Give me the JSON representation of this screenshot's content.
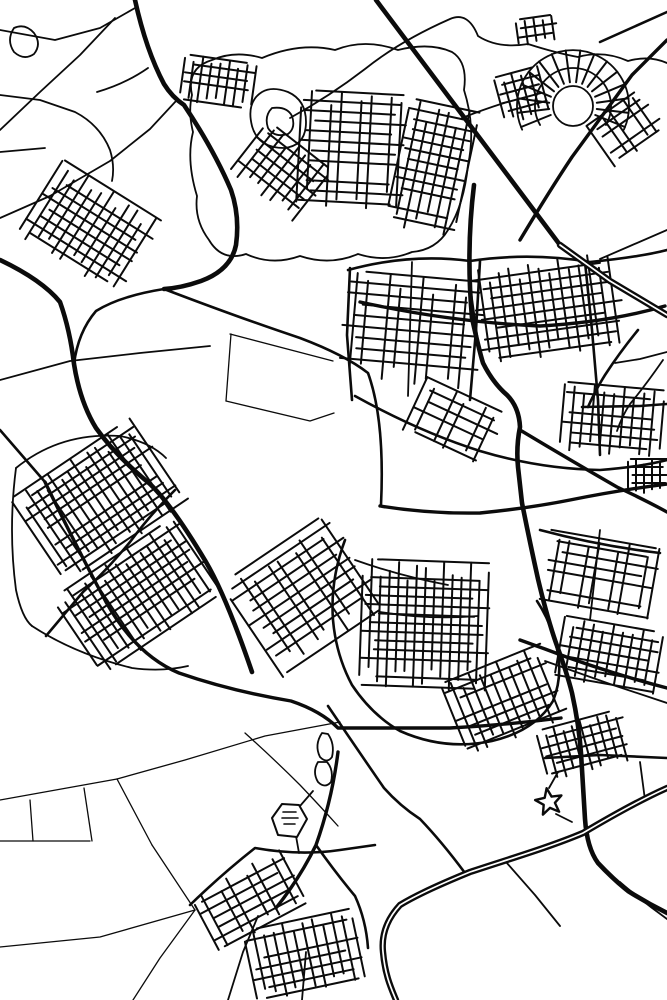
{
  "map": {
    "background": "#ffffff",
    "ink": "#0b0b0b",
    "landmark_fill": "#ffffff",
    "widths": {
      "xs": 1.3,
      "s": 1.8,
      "m": 2.6,
      "l": 3.4,
      "xl": 4.6,
      "grid": 2.0,
      "mw_outer": 6.4,
      "mw_inner": 1.7
    },
    "motorways": [
      "M667,788 C640,800 610,817 583,833 C550,847 506,860 470,872 C443,883 418,894 400,905 C388,918 381,933 383,952 C385,975 391,988 396,1000",
      "M560,245 L610,281 L667,315"
    ],
    "roads": [
      {
        "c": "xl",
        "d": "M376,0 L560,245"
      },
      {
        "c": "xl",
        "d": "M474,185 Q466,250 472,318 Q479,350 483,363 Q493,383 507,395 Q519,407 520,427 Q516,447 518,467 Q520,485 522,503 Q530,543 538,579 Q547,617 556,643 Q567,673 572,693 Q579,725 581,753 Q583,787 585,819 Q587,848 598,863 Q613,879 628,891 Q647,903 667,913"
      },
      {
        "c": "xl",
        "d": "M135,0 Q146,50 164,84 Q172,97 184,105 Q214,150 231,190 Q240,216 236,245 Q231,270 201,281 Q181,288 164,289"
      },
      {
        "c": "xl",
        "d": "M0,260 Q42,280 60,302 Q70,330 74,364 Q80,402 96,428 Q116,456 150,484 Q172,505 206,562 Q226,596 252,672"
      },
      {
        "c": "l",
        "d": "M45,482 Q76,546 106,602 Q136,655 179,673 Q231,691 291,701 Q321,711 338,728 L450,728 Q506,725 561,718"
      },
      {
        "c": "l",
        "d": "M380,506 Q430,514 480,513 Q530,508 570,500 Q620,490 667,484"
      },
      {
        "c": "l",
        "d": "M520,430 Q570,460 617,487 Q645,500 667,512"
      },
      {
        "c": "l",
        "d": "M520,640 L545,649 Q602,671 667,688"
      },
      {
        "c": "l",
        "d": "M667,40 L632,75 L572,157 Q550,190 520,240"
      },
      {
        "c": "l",
        "d": "M338,752 Q332,800 316,845 Q300,878 276,908"
      },
      {
        "c": "l",
        "d": "M360,302 Q450,322 540,326 Q610,322 665,306"
      },
      {
        "c": "m",
        "d": "M164,289 Q240,318 300,338 Q345,355 368,373 Q385,420 381,505"
      },
      {
        "c": "m",
        "d": "M164,289 Q120,296 96,311 Q78,332 74,364"
      },
      {
        "c": "m",
        "d": "M345,540 Q330,580 333,620 Q336,655 352,685 Q372,715 400,731 Q445,751 492,741 Q535,731 553,701 Q563,676 557,649 Q551,622 537,601"
      },
      {
        "c": "m",
        "d": "M348,270 Q410,253 470,261 Q530,252 590,262 Q640,257 667,250"
      },
      {
        "c": "m",
        "d": "M585,262 L592,330 L598,400 L600,455"
      },
      {
        "c": "m",
        "d": "M480,261 L476,330 L470,400"
      },
      {
        "c": "m",
        "d": "M355,396 Q420,432 480,451 Q540,469 600,470 Q640,467 667,460"
      },
      {
        "c": "m",
        "d": "M0,430 L45,482"
      },
      {
        "c": "m",
        "d": "M175,490 Q150,515 130,542 Q105,572 83,592 L46,636"
      },
      {
        "c": "m",
        "d": "M316,845 Q335,872 355,896 Q366,920 368,948"
      },
      {
        "c": "m",
        "d": "M190,905 Q222,874 255,848 Q300,856 340,850 L375,845"
      },
      {
        "c": "m",
        "d": "M328,706 Q355,746 384,788 Q400,806 420,819 Q442,842 465,873"
      },
      {
        "c": "m",
        "d": "M545,758 L600,755 L667,758"
      },
      {
        "c": "m",
        "d": "M600,42 L667,12"
      },
      {
        "c": "m",
        "d": "M582,407 L640,406 L667,404"
      },
      {
        "c": "m",
        "d": "M638,330 Q620,352 605,375 Q595,391 588,407"
      },
      {
        "c": "m",
        "d": "M540,530 Q600,546 660,553"
      },
      {
        "c": "m",
        "d": "M350,268 L347,335 L352,400"
      },
      {
        "c": "s",
        "d": "M0,30 L55,40 L100,28 L135,8"
      },
      {
        "c": "s",
        "d": "M0,95 L40,100 L75,112 Q100,125 110,150 Q115,166 112,181"
      },
      {
        "c": "s",
        "d": "M0,152 L45,148"
      },
      {
        "c": "s",
        "d": "M0,218 L50,196 L110,161 L150,129 L176,101"
      },
      {
        "c": "s",
        "d": "M0,130 L40,92 L80,55 L115,18"
      },
      {
        "c": "s",
        "d": "M148,68 Q125,84 97,92"
      },
      {
        "c": "s",
        "d": "M0,380 L70,361 L140,353 L210,346"
      },
      {
        "c": "s",
        "d": "M290,118 Q330,96 365,69 Q400,41 450,19 Q468,11 478,36 Q498,49 528,44 Q556,53 578,57 Q603,50 628,61 Q649,55 667,63"
      },
      {
        "c": "s",
        "d": "M462,118 Q482,110 504,103"
      },
      {
        "c": "s",
        "d": "M667,230 L630,246 L600,259"
      },
      {
        "c": "s",
        "d": "M667,352 L640,359 L615,363"
      },
      {
        "c": "s",
        "d": "M663,360 Q645,386 630,404 Q622,416 617,431"
      },
      {
        "c": "s",
        "d": "M545,661 L610,684 L667,703"
      },
      {
        "c": "s",
        "d": "M506,862 L535,895 L560,926"
      },
      {
        "c": "s",
        "d": "M556,814 L572,822"
      },
      {
        "c": "s",
        "d": "M549,788 L558,772"
      },
      {
        "c": "s",
        "d": "M300,806 L313,791"
      },
      {
        "c": "s",
        "d": "M296,836 L299,853"
      },
      {
        "c": "s",
        "d": "M620,882 Q642,901 667,919"
      },
      {
        "c": "s",
        "d": "M600,530 L595,575 L590,620"
      },
      {
        "c": "s",
        "d": "M355,560 Q400,576 448,585"
      },
      {
        "c": "s",
        "d": "M380,612 Q430,620 478,616"
      },
      {
        "c": "s",
        "d": "M412,262 L408,396"
      },
      {
        "c": "s",
        "d": "M640,762 L645,800"
      },
      {
        "c": "s",
        "d": "M228,1000 L243,952 L258,916"
      },
      {
        "c": "s",
        "d": "M302,1000 L306,952"
      },
      {
        "c": "s",
        "d": "M192,95 Q186,68 212,60 Q235,50 262,58 Q300,42 335,50 Q365,38 398,50 Q430,42 452,52 Q468,62 464,90 Q476,128 468,165 Q464,205 448,230 Q436,250 412,252 Q386,263 358,254 Q330,266 300,256 Q272,266 246,254 Q222,262 209,240 Q194,220 197,196 Q186,160 193,132 Q188,112 192,95 Z"
      },
      {
        "c": "s",
        "d": "M16,468 Q60,432 120,436 Q150,442 166,458"
      },
      {
        "c": "s",
        "d": "M16,468 Q8,530 16,590 Q22,618 32,626"
      },
      {
        "c": "s",
        "d": "M32,626 Q75,654 132,668 Q162,672 188,666"
      },
      {
        "c": "s",
        "d": "M14,28 Q6,40 14,52 Q24,61 34,54 Q42,44 34,33 Q25,23 14,28 Z"
      },
      {
        "c": "s",
        "d": "M322,733 Q314,745 320,757 Q327,764 332,757 Q335,744 328,734 Z"
      },
      {
        "c": "s",
        "d": "M318,762 Q312,772 318,782 Q325,789 331,782 Q334,770 327,762 Z"
      },
      {
        "c": "s",
        "d": "M262,92 Q246,102 252,126 Q258,148 284,148 Q306,146 306,122 Q306,100 288,92 Q272,86 262,92 Z"
      },
      {
        "c": "s",
        "d": "M272,108 Q264,116 268,128 Q274,138 288,134 Q296,128 292,116 Q287,106 272,108 Z"
      },
      {
        "c": "xs",
        "d": "M230,334 L333,361"
      },
      {
        "c": "xs",
        "d": "M231,334 L226,401"
      },
      {
        "c": "xs",
        "d": "M226,401 L310,421 L334,413"
      },
      {
        "c": "xs",
        "d": "M0,800 L117,779"
      },
      {
        "c": "xs",
        "d": "M117,779 L152,845"
      },
      {
        "c": "xs",
        "d": "M30,800 L33,841"
      },
      {
        "c": "xs",
        "d": "M84,788 L92,841"
      },
      {
        "c": "xs",
        "d": "M0,841 L90,841"
      },
      {
        "c": "xs",
        "d": "M0,947 L100,937 L195,910"
      },
      {
        "c": "xs",
        "d": "M195,910 L160,958 L133,1000"
      },
      {
        "c": "xs",
        "d": "M152,845 L195,910"
      },
      {
        "c": "xs",
        "d": "M117,779 L185,760 L265,736 L340,722"
      },
      {
        "c": "xs",
        "d": "M245,733 Q275,760 300,785 Q320,806 338,826"
      }
    ],
    "grids": [
      [
        218,
        82,
        72,
        46,
        8,
        9
      ],
      [
        282,
        172,
        84,
        64,
        38,
        10
      ],
      [
        352,
        150,
        106,
        115,
        3,
        10
      ],
      [
        432,
        168,
        70,
        128,
        12,
        10
      ],
      [
        90,
        228,
        118,
        88,
        32,
        10
      ],
      [
        627,
        128,
        64,
        50,
        -35,
        9
      ],
      [
        522,
        95,
        46,
        48,
        -15,
        9
      ],
      [
        537,
        30,
        40,
        26,
        -8,
        9
      ],
      [
        412,
        330,
        140,
        108,
        5,
        11
      ],
      [
        548,
        308,
        148,
        95,
        -8,
        10
      ],
      [
        612,
        420,
        100,
        68,
        5,
        10
      ],
      [
        455,
        422,
        88,
        58,
        25,
        11
      ],
      [
        100,
        500,
        148,
        102,
        -34,
        9
      ],
      [
        140,
        595,
        150,
        92,
        -34,
        9
      ],
      [
        305,
        595,
        128,
        112,
        -34,
        10
      ],
      [
        425,
        625,
        128,
        128,
        2,
        9
      ],
      [
        505,
        700,
        108,
        78,
        -22,
        10
      ],
      [
        600,
        575,
        112,
        72,
        10,
        10
      ],
      [
        610,
        655,
        102,
        62,
        10,
        10
      ],
      [
        585,
        745,
        88,
        52,
        -15,
        9
      ],
      [
        250,
        900,
        102,
        62,
        -28,
        10
      ],
      [
        305,
        955,
        112,
        72,
        -12,
        10
      ],
      [
        648,
        476,
        40,
        34,
        0,
        8
      ]
    ],
    "fan": {
      "cx": 573,
      "cy": 106,
      "rings": [
        20
      ],
      "arcs": [
        [
          38,
          150,
          390
        ],
        [
          56,
          155,
          385
        ]
      ],
      "spokes": 16,
      "r_in": 24,
      "r_out": 56,
      "a0": 158,
      "a1": 382
    },
    "star": {
      "cx": 549,
      "cy": 802,
      "r_outer": 14,
      "r_inner": 6,
      "points": 5,
      "rot": -100
    },
    "fort": {
      "outline": "M272,818 L282,804 L299,805 L307,819 L297,837 L278,835 Z",
      "inner": "M283,812 L296,812 M282,818 L298,818 M284,824 L295,824"
    }
  }
}
